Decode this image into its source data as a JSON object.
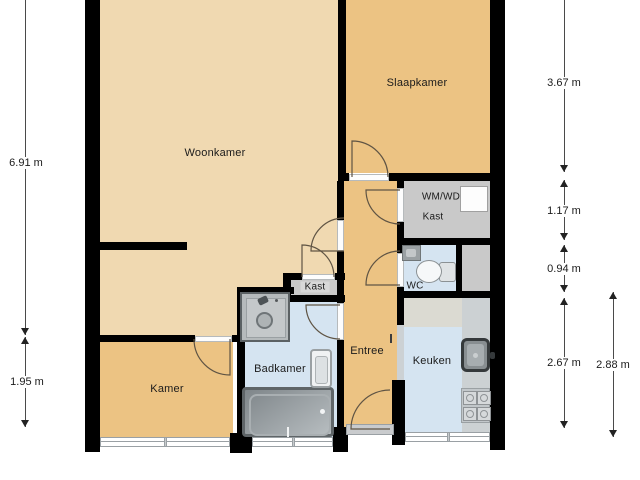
{
  "plan_title": "apartment-floor-plan",
  "colors": {
    "room_tan": "#f0d9b1",
    "room_orange": "#ecc383",
    "room_blue": "#d5e4f1",
    "closet_gray": "#c9c9c9",
    "counter_gray": "#ccd1d3",
    "counter_top_gray": "#dbdad2",
    "wall_black": "#000000"
  },
  "rooms": {
    "woonkamer": "Woonkamer",
    "slaapkamer": "Slaapkamer",
    "kamer": "Kamer",
    "badkamer": "Badkamer",
    "entree": "Entree",
    "keuken": "Keuken",
    "wc": "WC",
    "kast_hal": "Kast",
    "wmwd_line1": "WM/WD",
    "wmwd_line2": "Kast"
  },
  "dimensions": {
    "left": [
      "6.91 m",
      "1.95 m"
    ],
    "right": [
      "3.67 m",
      "1.17 m",
      "0.94 m",
      "2.67 m",
      "2.88 m"
    ]
  },
  "fixtures": [
    "bathtub",
    "shower",
    "washbasin",
    "toilet",
    "wc-sink",
    "kitchen-sink",
    "stove",
    "washing-machine"
  ]
}
